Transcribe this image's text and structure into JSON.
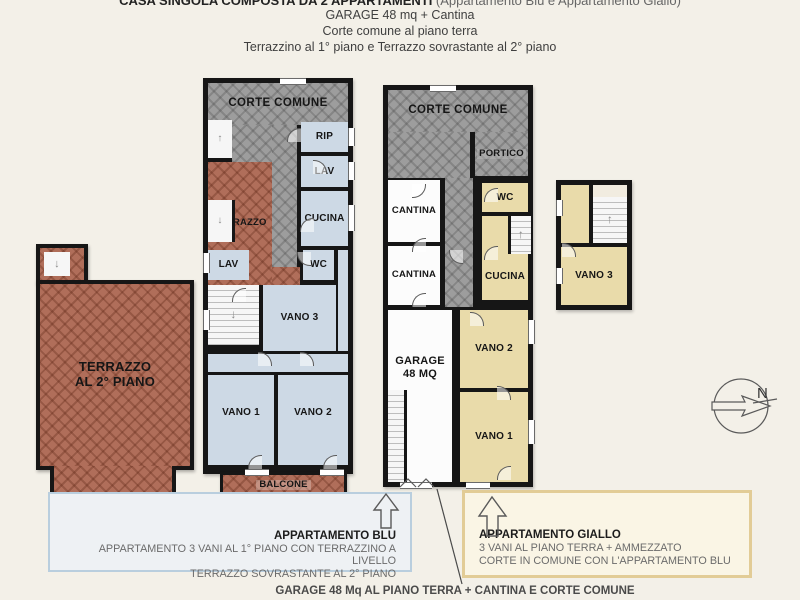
{
  "title": {
    "line1_bold": "CASA SINGOLA COMPOSTA DA 2 APPARTAMENTI",
    "line1_note": " (Appartamento Blu e Appartamento Giallo)",
    "line2": "GARAGE 48 mq + Cantina",
    "line3": "Corte comune al piano terra",
    "line4": "Terrazzino al 1° piano e Terrazzo sovrastante al 2° piano"
  },
  "plan_first_floor": {
    "corte_comune": "CORTE COMUNE",
    "rip": "RIP",
    "lav_top": "LAV",
    "terrazzo": "TERRAZZO",
    "cucina": "CUCINA",
    "lav": "LAV",
    "wc": "WC",
    "vano_3": "VANO 3",
    "vano_1": "VANO 1",
    "vano_2": "VANO 2",
    "balcone": "BALCONE"
  },
  "plan_ground_floor": {
    "corte_comune": "CORTE COMUNE",
    "portico": "PORTICO",
    "wc": "WC",
    "cantina_1": "CANTINA",
    "cantina_2": "CANTINA",
    "cucina": "CUCINA",
    "garage_line1": "GARAGE",
    "garage_line2": "48 MQ",
    "vano_2": "VANO 2",
    "vano_1": "VANO 1"
  },
  "plan_mezzanine": {
    "vano_3": "VANO 3"
  },
  "plan_terrace": {
    "line1": "TERRAZZO",
    "line2": "AL 2° PIANO"
  },
  "legend_blue": {
    "title": "APPARTAMENTO BLU",
    "line1": "APPARTAMENTO 3 VANI AL 1° PIANO CON TERRAZZINO A LIVELLO",
    "line2": "TERRAZZO SOVRASTANTE AL 2° PIANO"
  },
  "legend_yellow": {
    "title": "APPARTAMENTO GIALLO",
    "line1": "3 VANI AL PIANO TERRA + AMMEZZATO",
    "line2": "CORTE IN COMUNE CON L'APPARTAMENTO BLU"
  },
  "footer_note": "GARAGE 48 Mq AL PIANO TERRA + CANTINA E CORTE COMUNE",
  "compass": {
    "north_label": "N"
  },
  "colors": {
    "wall": "#161616",
    "paving_gray": "#9d9d9d",
    "terrace_red": "#b06e5a",
    "room_blue": "#cdd9e5",
    "room_tan": "#e9dbaa",
    "legend_blue_border": "#b9cede",
    "legend_yellow_border": "#e2cc96"
  }
}
